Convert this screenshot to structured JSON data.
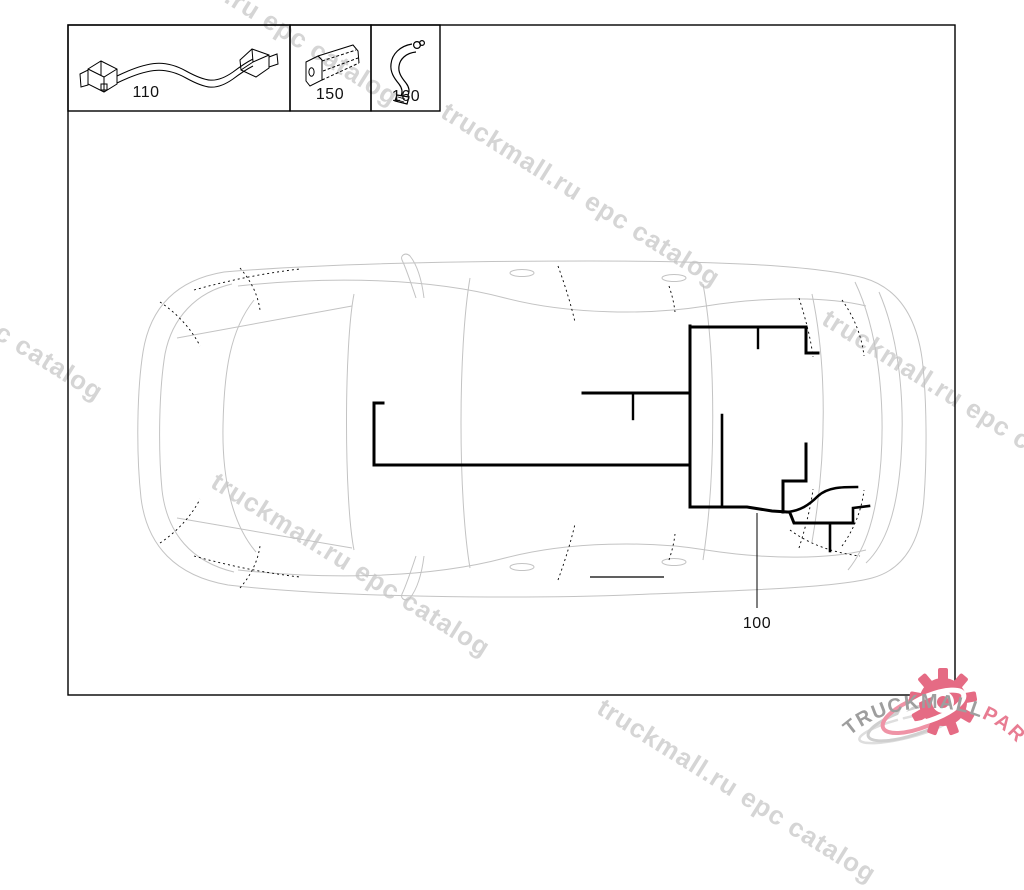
{
  "watermark": {
    "text": "truckmall.ru epc catalog",
    "color": "#d5d5d5"
  },
  "legend": {
    "items": [
      {
        "label": "110"
      },
      {
        "label": "150"
      },
      {
        "label": "160"
      }
    ]
  },
  "callout": {
    "label": "100"
  },
  "logo": {
    "gray_text": "TRUCKMALL",
    "pink_text": "PARTS",
    "pink": "#e56b84",
    "gray": "#9e9e9e"
  },
  "colors": {
    "frame": "#000000",
    "car_outline": "#c3c3c3",
    "harness": "#000000",
    "watermark": "#d5d5d5"
  }
}
